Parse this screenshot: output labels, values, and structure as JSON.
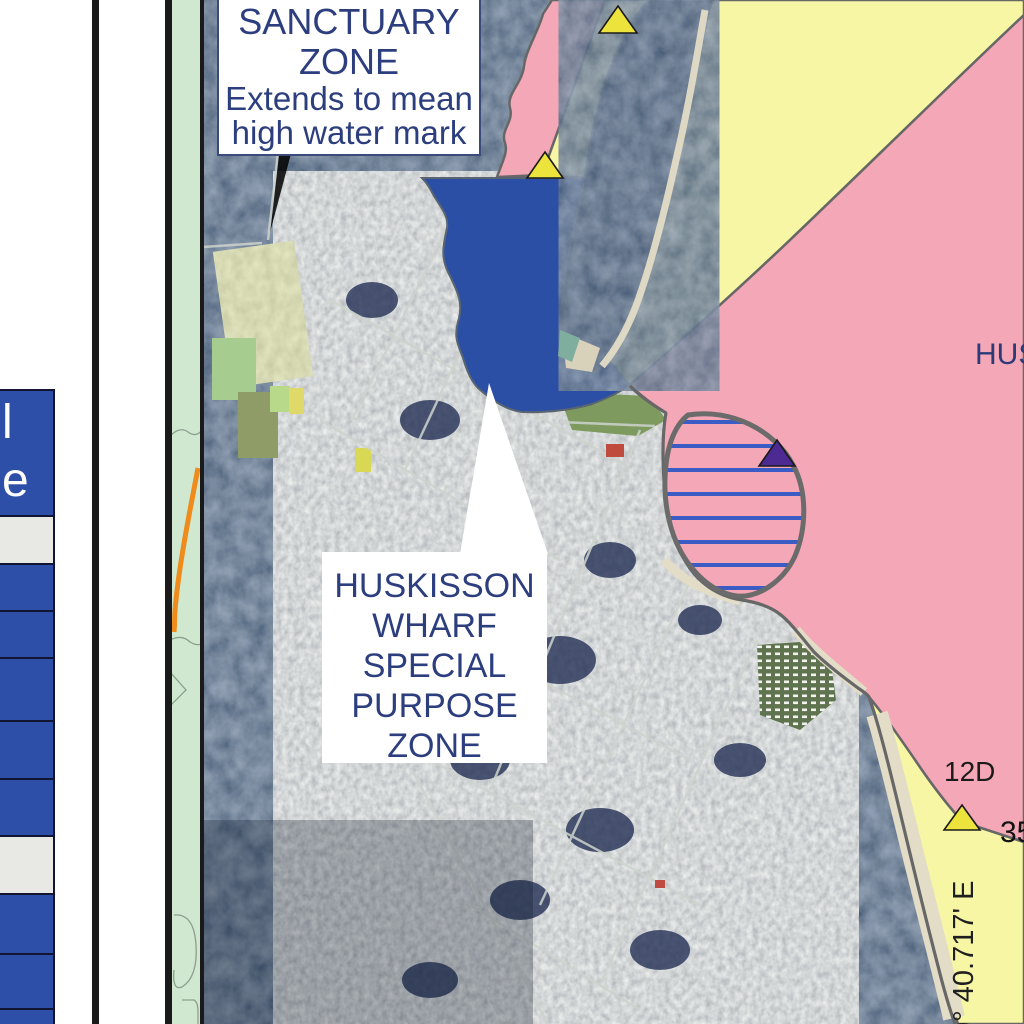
{
  "window": {
    "description": "Marine park zoning map over aerial imagery, Huskisson area"
  },
  "legend": {
    "partial_label_line1": "l",
    "partial_label_line2": "e",
    "swatches": [
      {
        "color": "blue",
        "height": 124
      },
      {
        "color": "gray",
        "height": 46
      },
      {
        "color": "blue",
        "height": 45
      },
      {
        "color": "blue",
        "height": 45
      },
      {
        "color": "blue",
        "height": 61
      },
      {
        "color": "blue",
        "height": 56
      },
      {
        "color": "blue",
        "height": 55
      },
      {
        "color": "gray",
        "height": 56
      },
      {
        "color": "blue",
        "height": 58
      },
      {
        "color": "blue",
        "height": 53
      },
      {
        "color": "blue",
        "height": 18
      }
    ]
  },
  "callouts": {
    "sanctuary": {
      "lines": [
        "SANCTUARY",
        "ZONE",
        "Extends to mean",
        "high water mark"
      ]
    },
    "wharf": {
      "lines": [
        "HUSKISSON",
        "WHARF",
        "SPECIAL",
        "PURPOSE",
        "ZONE"
      ]
    }
  },
  "labels": {
    "place_partial": "HUS",
    "zone_ref": "12D",
    "latitude_partial": "35",
    "longitude": "0° 40.717' E"
  },
  "markers": {
    "yellow_triangle_count": "3",
    "purple_triangle_count": "1"
  },
  "colors": {
    "legend_blue": "#2e4fa7",
    "legend_gray": "#e8e8e4",
    "legend_border": "#121531",
    "zone_sanctuary_pink": "#f4a7b6",
    "zone_habitat_yellow": "#f6f6a5",
    "zone_special_blue": "#2b4fa4",
    "zone_boundary_gray": "#676767",
    "stripe_blue": "#3b5cc4",
    "marker_yellow": "#ece43c",
    "marker_purple": "#4c2a91",
    "callout_text_navy": "#2c3e7e",
    "map_label_black": "#1a1a1a",
    "road_orange": "#ef8b1a",
    "topo_green": "#cfe8cf",
    "beach_sand": "#e3dcc6"
  }
}
